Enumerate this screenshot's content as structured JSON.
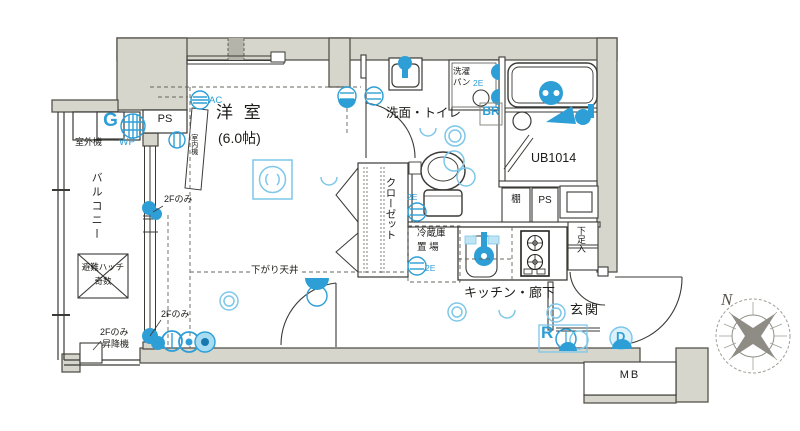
{
  "colors": {
    "accent_blue": "#2e9fd6",
    "accent_blue_light": "#7ec7e8",
    "wall_fill": "#d6d6cc"
  },
  "rooms": {
    "western_room_name": "洋 室",
    "western_room_size": "(6.0帖)",
    "washroom_toilet": "洗面・トイレ",
    "closet": "クローゼット",
    "kitchen_hallway": "キッチン・廊下",
    "entrance": "玄関",
    "balcony": "バルコニー",
    "unit_bath": "UB1014"
  },
  "labels": {
    "dropped_ceiling": "下がり天井",
    "laundry_pan_line1": "洗濯",
    "laundry_pan_line2": "パン",
    "fridge_line1": "冷蔵庫",
    "fridge_line2": "置 場",
    "shelf": "棚",
    "pipe_space": "PS",
    "shoe_cabinet": "下足入",
    "meter_box": "MB",
    "outdoor_ac_unit": "室外機",
    "indoor_ac_unit": "室内機",
    "evac_hatch_line1": "避難ハッチ",
    "evac_hatch_line2": "奇数",
    "lift": "昇降機",
    "second_floor_only": "2Fのみ"
  },
  "symbols": {
    "gas_meter": "G",
    "water_proof_outlet": "WP",
    "air_conditioner": "AC",
    "bath_remote": "BR",
    "ring": "R",
    "door_symbol": "D",
    "outlet_2e": "2E",
    "north": "N"
  }
}
